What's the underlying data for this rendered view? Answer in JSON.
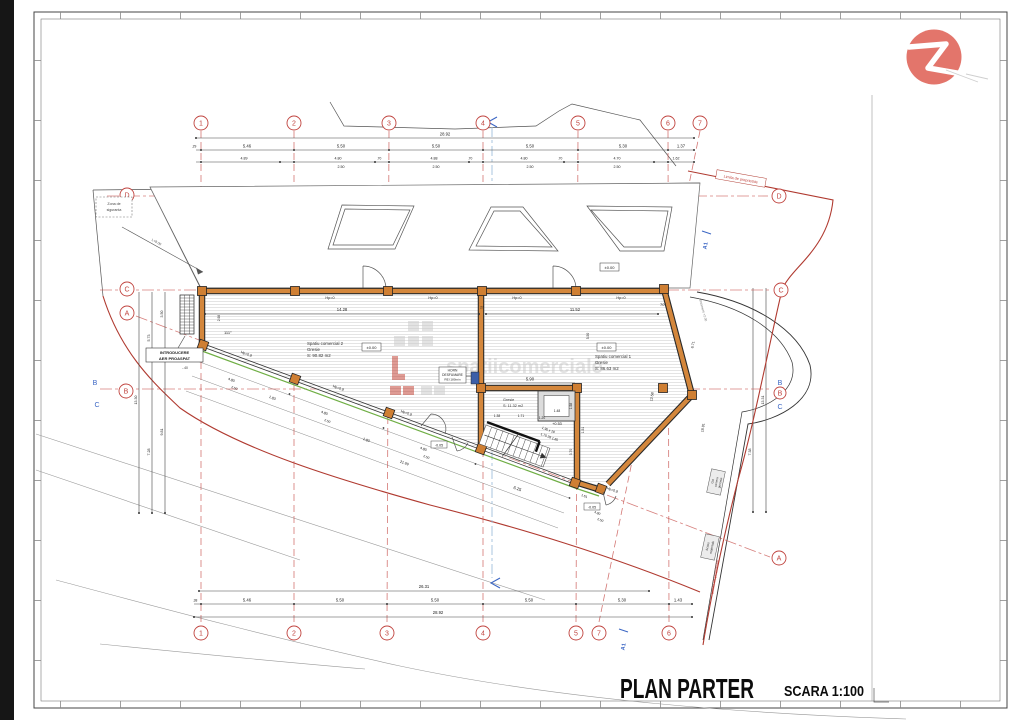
{
  "sheet": {
    "title": "PLAN PARTER",
    "scale": "SCARA 1:100"
  },
  "logo": {
    "letter": "Z",
    "color": "#e3756b"
  },
  "grid": {
    "top": [
      "1",
      "2",
      "3",
      "4",
      "5",
      "6",
      "7"
    ],
    "bottom": [
      "1",
      "2",
      "3",
      "4",
      "5",
      "7",
      "6"
    ],
    "letters": {
      "a": "A",
      "b": "B",
      "c": "C",
      "d": "D"
    }
  },
  "dims": {
    "top_total": "28.92",
    "top_stub": ".29",
    "top_row": [
      "5.46",
      "5.50",
      "5.50",
      "5.50",
      "5.30",
      "1.37"
    ],
    "top_sub": [
      "4.89",
      "4.80",
      ".70",
      "4.88",
      ".70",
      "4.80",
      ".70",
      "4.70",
      "1.62"
    ],
    "top_sub2": [
      "2.50",
      "2.50",
      "2.50",
      "2.50"
    ],
    "bot_inner": "26.31",
    "bot_stub": ".38",
    "bot_row": [
      "5.46",
      "5.50",
      "5.50",
      "5.50",
      "5.30",
      "1.43"
    ],
    "bot_total": "28.92",
    "left_v": [
      "3.50",
      "5.73",
      "7.28",
      "9.81",
      "13.30"
    ],
    "right_v": [
      "6.71",
      "12.58",
      "18.91",
      "7.38",
      "13.31"
    ],
    "room2_w": "14.28",
    "gap": "27",
    "room1_w": "11.52",
    "lobby_w": "5.90",
    "v550": "5.50",
    "v298": "2.98",
    "v370": "3.70",
    "v151": "1.51",
    "f480": "4.80",
    "f250": "2.50",
    "f183": "1.83",
    "front_total": "21.99",
    "stair_w": "6.25",
    "s161": "1.61",
    "lift_w": "1.48",
    "lift_d": "1.58",
    "l138": "1.38",
    "l171": "1.71",
    "l120": "1.20"
  },
  "levels": {
    "zero": "±0.00",
    "plus": "+0.53",
    "minus": "-0.05"
  },
  "angles": {
    "a111": "111°",
    "a70": "70°"
  },
  "rooms": {
    "r2": {
      "name": "Spatiu comercial 2",
      "finish": "Gresie",
      "area": "S: 90.82 m2"
    },
    "r1": {
      "name": "Spatiu comercial 1",
      "finish": "Gresie",
      "area": "S: 86.63 m2"
    },
    "lobby": {
      "finish": "Gresie",
      "area": "S: 11.32 m2"
    }
  },
  "labels": {
    "horn1": "HORN",
    "horn2": "DESFUMARE",
    "horn3": "REI 180min",
    "aer1": "INTRODUCERE",
    "aer2": "AER PROASPAT",
    "aer_note": "-.40",
    "sig1": "Zona de",
    "sig2": "siguranta",
    "limita": "Limita de proprietate",
    "hp0": "Hp=0",
    "hp09": "Hp=0,9",
    "slope": "L=8.00",
    "align": "Aliniament +2.00",
    "section": "A1",
    "box1": [
      "Gol",
      "camera",
      "gunoaie"
    ],
    "box2": [
      "Acces",
      "materiale"
    ],
    "stair1": "1.90 x 18",
    "stair2": "1.70  28  1.80"
  },
  "watermark": {
    "text": "spatiicomerciale"
  }
}
